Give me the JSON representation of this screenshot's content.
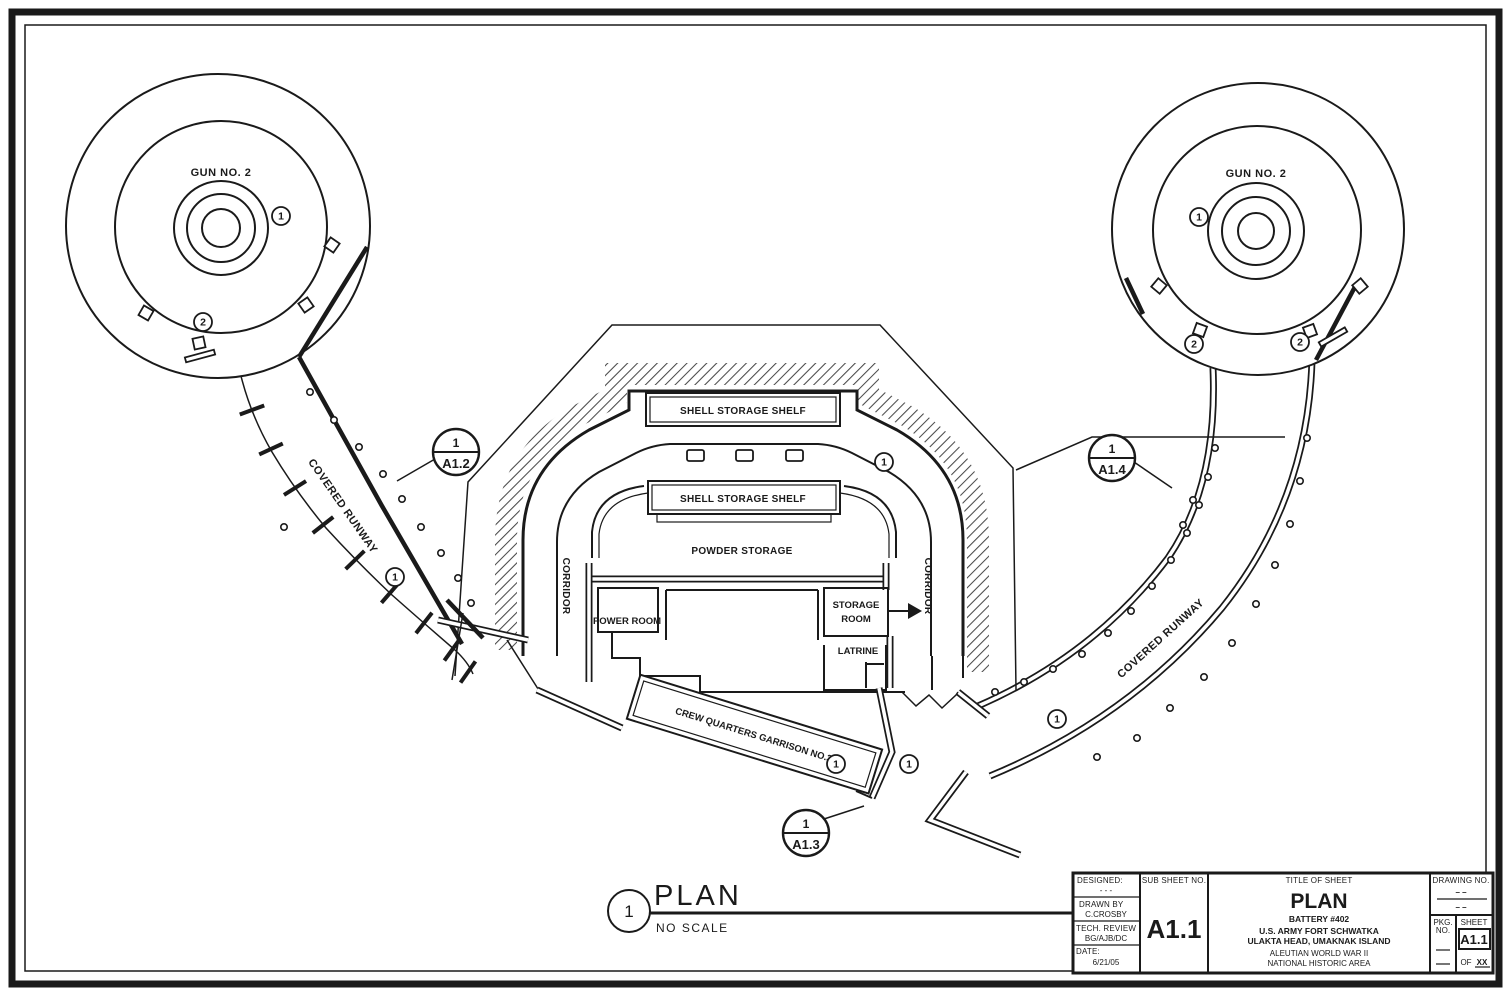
{
  "plan": {
    "gun_label": "GUN NO. 2",
    "shell_storage_shelf": "SHELL STORAGE SHELF",
    "powder_storage": "POWDER STORAGE",
    "corridor": "CORRIDOR",
    "power_room": "POWER ROOM",
    "storage_room_line1": "STORAGE",
    "storage_room_line2": "ROOM",
    "latrine": "LATRINE",
    "crew_quarters": "CREW QUARTERS GARRISON NO.3",
    "covered_runway": "COVERED RUNWAY",
    "keynote_1": "1",
    "keynote_2": "2",
    "callout_a12": {
      "num": "1",
      "sheet": "A1.2"
    },
    "callout_a13": {
      "num": "1",
      "sheet": "A1.3"
    },
    "callout_a14": {
      "num": "1",
      "sheet": "A1.4"
    },
    "view_title": {
      "num": "1",
      "title": "PLAN",
      "scale": "NO SCALE"
    }
  },
  "title_block": {
    "designed_label": "DESIGNED:",
    "designed_value": "- - -",
    "drawn_by_label": "DRAWN BY",
    "drawn_by_value": "C.CROSBY",
    "tech_review_label": "TECH. REVIEW",
    "tech_review_value": "BG/AJB/DC",
    "date_label": "DATE:",
    "date_value": "6/21/05",
    "sub_sheet_label": "SUB SHEET NO.",
    "sub_sheet_value": "A1.1",
    "title_of_sheet_label": "TITLE OF SHEET",
    "sheet_title": "PLAN",
    "battery": "BATTERY #402",
    "org_line1": "U.S. ARMY FORT SCHWATKA",
    "org_line2": "ULAKTA HEAD, UMAKNAK ISLAND",
    "area_line1": "ALEUTIAN WORLD WAR II",
    "area_line2": "NATIONAL HISTORIC AREA",
    "drawing_no_label": "DRAWING NO.",
    "drawing_no_dash1": "– –",
    "drawing_no_dash2": "– –",
    "pkg_no_label_1": "PKG.",
    "pkg_no_label_2": "NO.",
    "sheet_label": "SHEET",
    "sheet_value": "A1.1",
    "of_label": "OF",
    "of_value": "XX"
  },
  "colors": {
    "ink": "#1a1a1a",
    "paper": "#ffffff"
  }
}
